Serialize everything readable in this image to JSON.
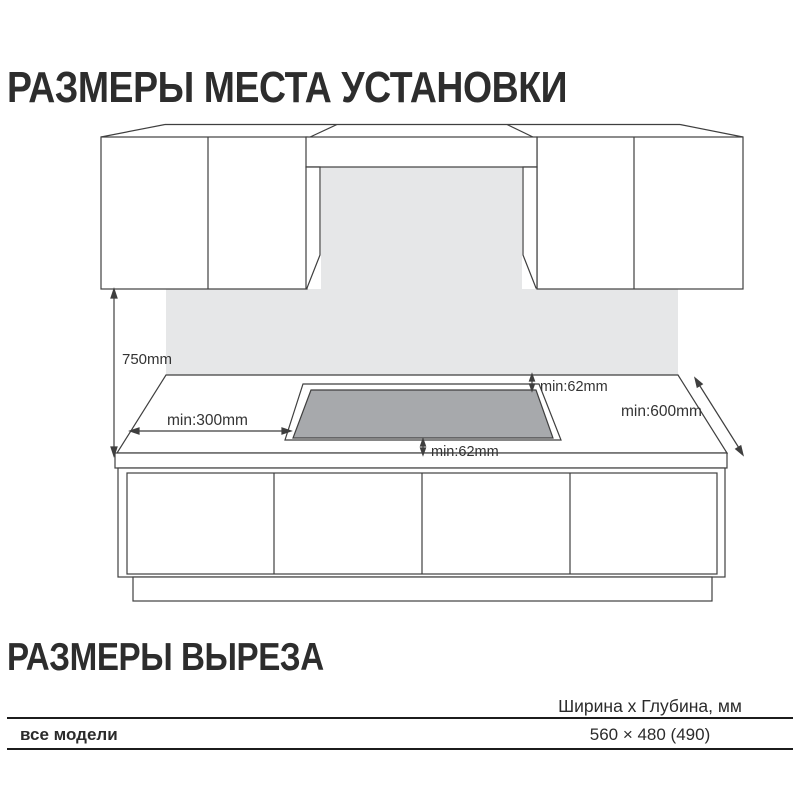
{
  "page": {
    "title_installation": "РАЗМЕРЫ МЕСТА УСТАНОВКИ",
    "title_cutout": "РАЗМЕРЫ ВЫРЕЗА"
  },
  "diagram": {
    "labels": {
      "wall_height": "750mm",
      "side_clearance": "min:300mm",
      "back_clearance": "min:62mm",
      "front_clearance": "min:62mm",
      "counter_depth": "min:600mm"
    },
    "colors": {
      "backsplash": "#e6e7e8",
      "cutout": "#a7a9ac",
      "line": "#3f3f3f"
    }
  },
  "table": {
    "header": "Ширина x Глубина, мм",
    "rows": [
      {
        "model": "все модели",
        "value": "560 × 480 (490)"
      }
    ]
  }
}
